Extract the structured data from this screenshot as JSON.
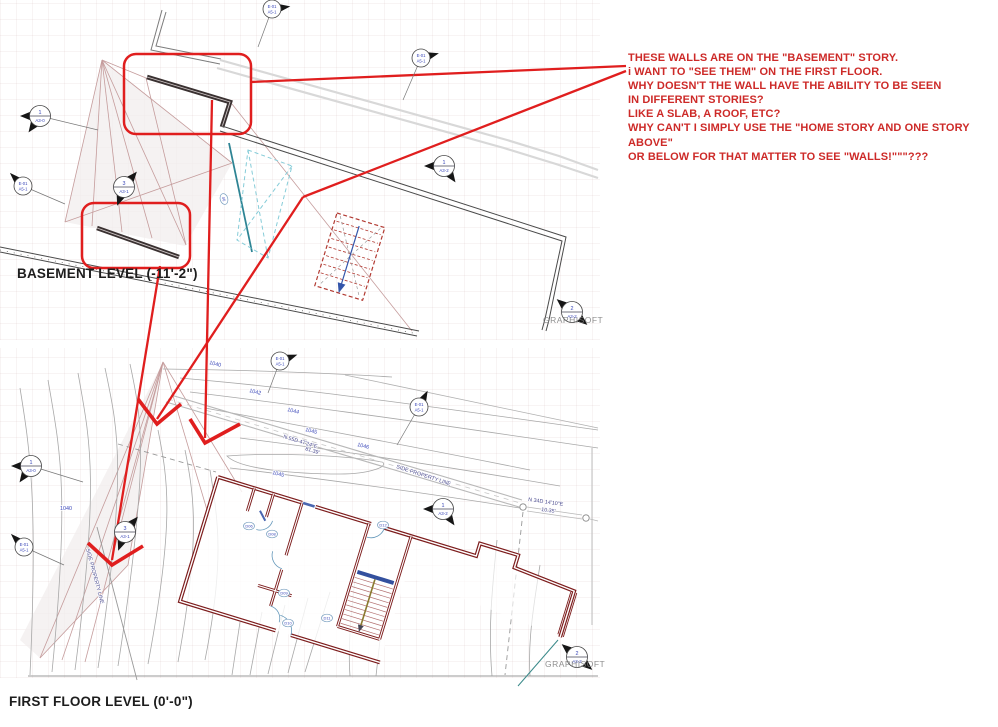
{
  "question_note": {
    "color": "#cd2a28",
    "lines": [
      "THESE WALLS ARE ON THE \"BASEMENT\" STORY.",
      "i WANT TO \"SEE THEM\" ON THE FIRST FLOOR.",
      "WHY DOESN'T THE WALL HAVE THE ABILITY TO BE SEEN",
      "IN DIFFERENT STORIES?",
      "LIKE A SLAB, A ROOF, ETC?",
      "WHY CAN'T I SIMPLY USE THE \"HOME STORY AND ONE STORY ABOVE\"",
      "OR BELOW FOR THAT MATTER TO SEE \"WALLS!\"\"\"???"
    ]
  },
  "plan_labels": {
    "basement": "BASEMENT LEVEL (-11'-2\")",
    "first_floor": "FIRST FLOOR LEVEL (0'-0\")"
  },
  "watermarks": [
    {
      "text": "GRAPHISOFT",
      "x": 543,
      "y": 323
    },
    {
      "text": "GRAPHISOFT",
      "x": 545,
      "y": 667
    }
  ],
  "markers": [
    {
      "kind": "section",
      "num": "1",
      "sheet": "A3-0",
      "x": 40,
      "y": 116,
      "flags": [
        180,
        125
      ],
      "leader": [
        58,
        14
      ]
    },
    {
      "kind": "section",
      "num": "3",
      "sheet": "A3-1",
      "x": 124,
      "y": 187,
      "flags": [
        -50,
        110
      ],
      "leader": [
        0,
        0
      ]
    },
    {
      "kind": "section",
      "num": "1",
      "sheet": "A3-2",
      "x": 444,
      "y": 166,
      "flags": [
        180,
        55
      ],
      "leader": [
        0,
        0
      ]
    },
    {
      "kind": "section",
      "num": "2",
      "sheet": "A3-2",
      "x": 572,
      "y": 312,
      "flags": [
        -140,
        40
      ],
      "leader": [
        0,
        0
      ]
    },
    {
      "kind": "ref",
      "lines": [
        "E-01",
        "A5-1"
      ],
      "x": 272,
      "y": 9,
      "flags": [
        -8
      ],
      "leader": [
        -14,
        38
      ]
    },
    {
      "kind": "ref",
      "lines": [
        "E-01",
        "A5-1"
      ],
      "x": 421,
      "y": 58,
      "flags": [
        -15
      ],
      "leader": [
        -18,
        42
      ]
    },
    {
      "kind": "ref",
      "lines": [
        "E-01",
        "A5-1"
      ],
      "x": 23,
      "y": 186,
      "flags": [
        -135
      ],
      "leader": [
        42,
        18
      ]
    },
    {
      "kind": "ref",
      "lines": [
        "E-01",
        "A5-1"
      ],
      "x": 280,
      "y": 361,
      "flags": [
        -20
      ],
      "leader": [
        -12,
        32
      ]
    },
    {
      "kind": "ref",
      "lines": [
        "E-01",
        "A5-1"
      ],
      "x": 419,
      "y": 407,
      "flags": [
        -62
      ],
      "leader": [
        -22,
        38
      ]
    },
    {
      "kind": "section",
      "num": "1",
      "sheet": "A3-0",
      "x": 31,
      "y": 466,
      "flags": [
        180,
        125
      ],
      "leader": [
        52,
        16
      ]
    },
    {
      "kind": "ref",
      "lines": [
        "E-01",
        "A5-1"
      ],
      "x": 24,
      "y": 547,
      "flags": [
        -135
      ],
      "leader": [
        40,
        18
      ]
    },
    {
      "kind": "section",
      "num": "3",
      "sheet": "A3-1",
      "x": 125,
      "y": 532,
      "flags": [
        -50,
        110
      ],
      "leader": [
        0,
        0
      ]
    },
    {
      "kind": "section",
      "num": "1",
      "sheet": "A3-2",
      "x": 443,
      "y": 509,
      "flags": [
        180,
        55
      ],
      "leader": [
        0,
        0
      ]
    },
    {
      "kind": "section",
      "num": "2",
      "sheet": "A3-2",
      "x": 577,
      "y": 657,
      "flags": [
        -140,
        40
      ],
      "leader": [
        0,
        0
      ]
    }
  ],
  "door_tags": [
    {
      "text": "D06",
      "x": 249,
      "y": 526,
      "rot": 0
    },
    {
      "text": "D08",
      "x": 272,
      "y": 534,
      "rot": 0
    },
    {
      "text": "D09",
      "x": 284,
      "y": 593,
      "rot": 0
    },
    {
      "text": "D10",
      "x": 288,
      "y": 623,
      "rot": 0
    },
    {
      "text": "D11",
      "x": 327,
      "y": 618,
      "rot": 0
    },
    {
      "text": "D12",
      "x": 383,
      "y": 525,
      "rot": 0
    },
    {
      "text": "06",
      "x": 224,
      "y": 199,
      "rot": 75
    }
  ],
  "contour_labels": [
    {
      "text": "1040",
      "x": 209,
      "y": 364,
      "rot": 14
    },
    {
      "text": "1042",
      "x": 249,
      "y": 392,
      "rot": 14
    },
    {
      "text": "1044",
      "x": 287,
      "y": 411,
      "rot": 14
    },
    {
      "text": "1045",
      "x": 305,
      "y": 431,
      "rot": 14
    },
    {
      "text": "1046",
      "x": 357,
      "y": 446,
      "rot": 14
    },
    {
      "text": "1045",
      "x": 272,
      "y": 474,
      "rot": 14
    },
    {
      "text": "1040",
      "x": 60,
      "y": 510,
      "rot": 0
    }
  ],
  "survey_labels": [
    {
      "text": "N 55D 47'24\"E",
      "x": 283,
      "y": 438,
      "rot": 17
    },
    {
      "text": "81.39'",
      "x": 305,
      "y": 450,
      "rot": 17
    },
    {
      "text": "N 34D 14'10\"E",
      "x": 528,
      "y": 501,
      "rot": 8
    },
    {
      "text": "10.35'",
      "x": 541,
      "y": 511,
      "rot": 8
    },
    {
      "text": "SIDE PROPERTY LINE",
      "x": 396,
      "y": 468,
      "rot": 18
    },
    {
      "text": "SIDE PROPERTY LINE",
      "x": 86,
      "y": 549,
      "rot": 75
    }
  ]
}
